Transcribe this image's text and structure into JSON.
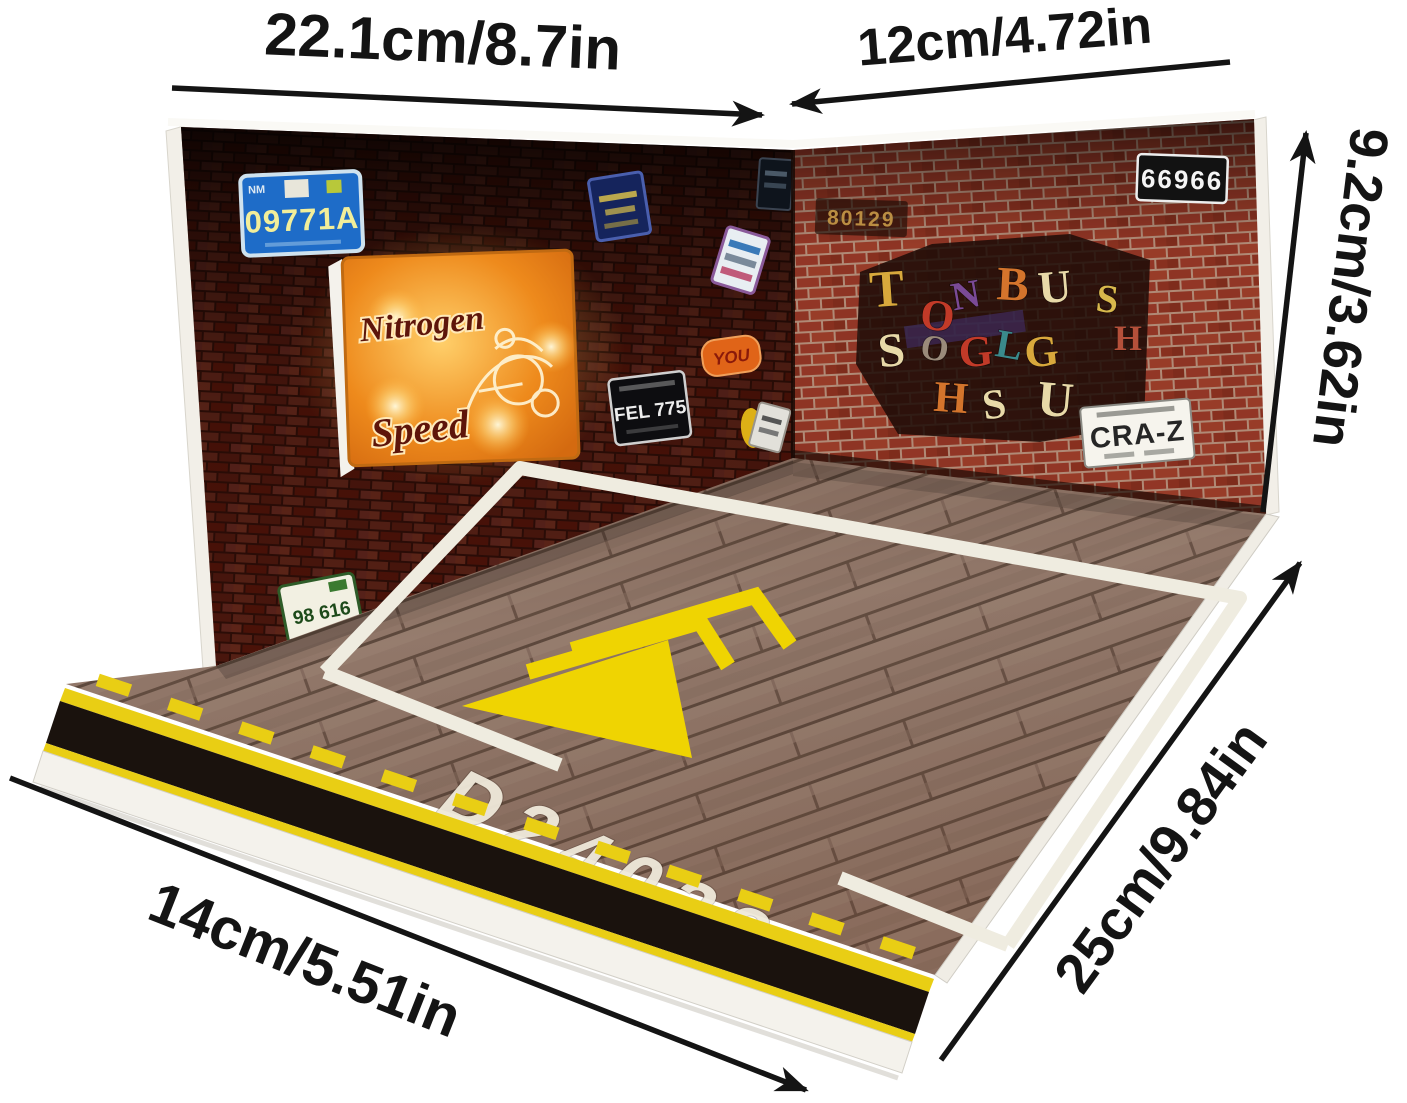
{
  "dimensions": {
    "top_width": "22.1cm/8.7in",
    "back_depth": "12cm/4.72in",
    "wall_height": "9.2cm/3.62in",
    "floor_depth": "25cm/9.84in",
    "front_width": "14cm/5.51in"
  },
  "scene": {
    "left_wall": {
      "plate_blue_text": "09771A",
      "plate_blue_state": "NM",
      "neon_sign": {
        "line1": "Nitrogen",
        "line2": "Speed"
      },
      "sticker_orange_text": "YOU",
      "plate_black_text": "FEL 775",
      "plate_green_text": "98 616"
    },
    "right_wall": {
      "tag_text": "80129",
      "plate_top_text": "66966",
      "plate_bottom_text": "CRA-Z",
      "collage": {
        "letters": [
          {
            "ch": "T",
            "x": 888,
            "y": 306,
            "s": 52,
            "r": -4,
            "c": "#d8a83c"
          },
          {
            "ch": "O",
            "x": 936,
            "y": 330,
            "s": 44,
            "r": 6,
            "c": "#c23a28"
          },
          {
            "ch": "N",
            "x": 968,
            "y": 308,
            "s": 40,
            "r": -10,
            "c": "#7a4a96"
          },
          {
            "ch": "B",
            "x": 1012,
            "y": 300,
            "s": 48,
            "r": 3,
            "c": "#d4742c"
          },
          {
            "ch": "U",
            "x": 1056,
            "y": 302,
            "s": 46,
            "r": -5,
            "c": "#e8d9a8"
          },
          {
            "ch": "S",
            "x": 1106,
            "y": 312,
            "s": 40,
            "r": 6,
            "c": "#d8b84c"
          },
          {
            "ch": "H",
            "x": 1128,
            "y": 350,
            "s": 36,
            "r": 0,
            "c": "#b5503a"
          },
          {
            "ch": "S",
            "x": 893,
            "y": 366,
            "s": 48,
            "r": -6,
            "c": "#e8d9a8"
          },
          {
            "ch": "O",
            "x": 933,
            "y": 360,
            "s": 36,
            "r": 9,
            "c": "#9a8a7a"
          },
          {
            "ch": "G",
            "x": 977,
            "y": 366,
            "s": 44,
            "r": -5,
            "c": "#c23a28"
          },
          {
            "ch": "L",
            "x": 1007,
            "y": 358,
            "s": 40,
            "r": 10,
            "c": "#3a8a8c"
          },
          {
            "ch": "G",
            "x": 1043,
            "y": 366,
            "s": 44,
            "r": -6,
            "c": "#d8a83c"
          },
          {
            "ch": "H",
            "x": 950,
            "y": 412,
            "s": 44,
            "r": 4,
            "c": "#d4742c"
          },
          {
            "ch": "S",
            "x": 996,
            "y": 418,
            "s": 42,
            "r": -8,
            "c": "#e8d9a8"
          },
          {
            "ch": "U",
            "x": 1054,
            "y": 416,
            "s": 50,
            "r": 5,
            "c": "#e8d9a8"
          }
        ]
      }
    },
    "floor": {
      "stencil_code": "D24038"
    },
    "colors": {
      "dimension_ink": "#141414",
      "hazard_yellow": "#e9ce14",
      "hazard_black": "#1a120d",
      "marking_white": "#efece0",
      "chevron_yellow": "#efd402",
      "neon_orange": "#ee8a1c",
      "plate_blue": "#1e6cc8",
      "brick_left": "#4f1a10",
      "brick_right": "#8e3424",
      "wood": "#93796b"
    }
  }
}
